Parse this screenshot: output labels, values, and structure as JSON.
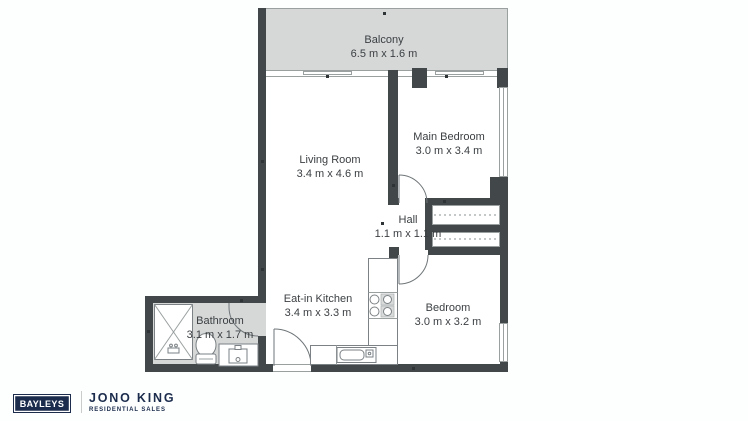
{
  "colors": {
    "wall": "#42474a",
    "fill": "#d6d8d8",
    "line": "#9aa0a0",
    "text": "#3c4043",
    "navy": "#1b2c4c",
    "bg": "#fdfefe"
  },
  "rooms": {
    "balcony": {
      "name": "Balcony",
      "dims": "6.5 m x 1.6 m"
    },
    "living_room": {
      "name": "Living Room",
      "dims": "3.4 m x 4.6 m"
    },
    "main_bedroom": {
      "name": "Main Bedroom",
      "dims": "3.0 m x 3.4 m"
    },
    "hall": {
      "name": "Hall",
      "dims": "1.1 m x 1.1 m"
    },
    "kitchen": {
      "name": "Eat-in Kitchen",
      "dims": "3.4 m x 3.3 m"
    },
    "bedroom": {
      "name": "Bedroom",
      "dims": "3.0 m x 3.2 m"
    },
    "bathroom": {
      "name": "Bathroom",
      "dims": "3.1 m x 1.7 m"
    }
  },
  "branding": {
    "agency": "BAYLEYS",
    "agent": "JONO KING",
    "tagline": "RESIDENTIAL SALES"
  }
}
